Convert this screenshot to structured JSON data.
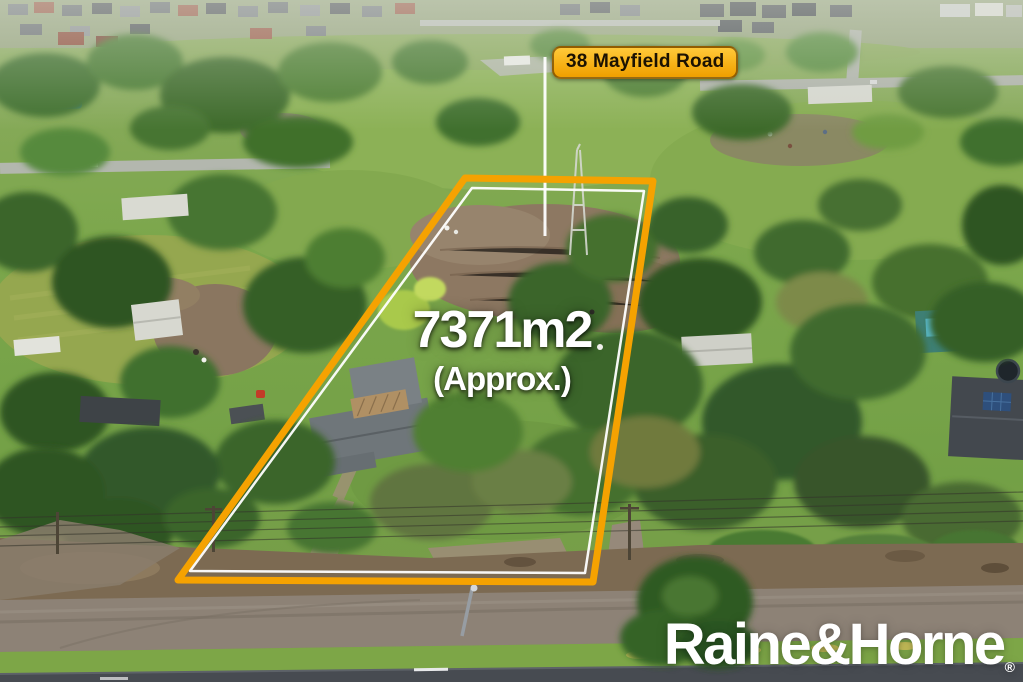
{
  "overlay": {
    "address_label": "38 Mayfield Road",
    "area_value": "7371m2",
    "area_qualifier": "(Approx.)",
    "boundary": {
      "points": "465,178 653,181 593,582 178,580",
      "inner_points": "472,188 644,191 585,573 190,571",
      "color": "#F5A201",
      "inner_color": "#FFFFFF"
    },
    "pointer_line": {
      "x1": 545,
      "y1": 57,
      "x2": 545,
      "y2": 236,
      "color": "#FFFFFF"
    },
    "label_colors": {
      "background_top": "#FFC93A",
      "background_bottom": "#EF9F00",
      "border": "#5E3800",
      "text": "#1C1202"
    },
    "annotation_text_color": "#FFFFFF"
  },
  "brand": {
    "name": "Raine&Horne",
    "registered_mark": "®"
  }
}
